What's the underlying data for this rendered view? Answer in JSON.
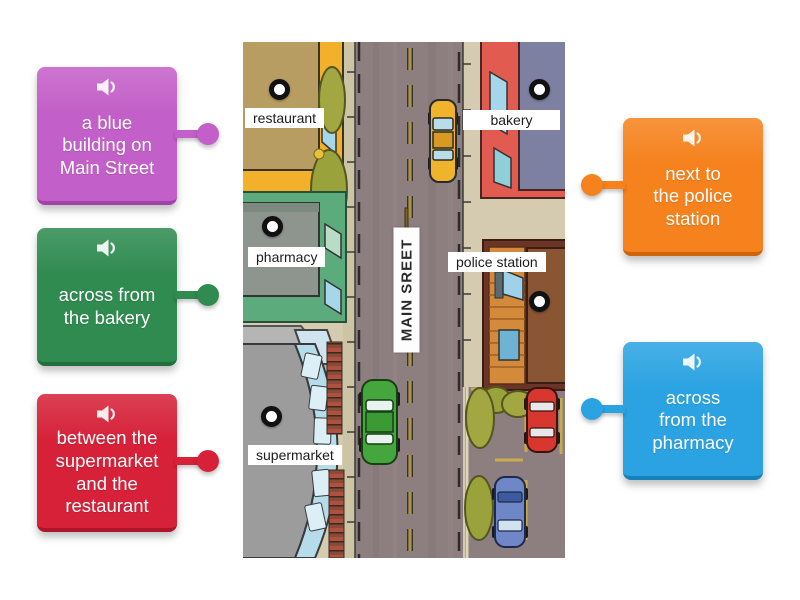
{
  "activity": {
    "type": "labelled-diagram",
    "cards": [
      {
        "id": "card-blue-building",
        "text": "a blue\nbuilding on\nMain Street",
        "color": "#c35fc8",
        "edge_color": "#a144a8",
        "side": "left",
        "audio_icon": "speaker"
      },
      {
        "id": "card-across-bakery",
        "text": "across from\nthe bakery",
        "color": "#2f8b50",
        "edge_color": "#226e3c",
        "side": "left",
        "audio_icon": "speaker"
      },
      {
        "id": "card-between",
        "text": "between the\nsupermarket\nand the\nrestaurant",
        "color": "#d62138",
        "edge_color": "#ae152a",
        "side": "left",
        "audio_icon": "speaker"
      },
      {
        "id": "card-next-police",
        "text": "next to\nthe police\nstation",
        "color": "#f5821d",
        "edge_color": "#cf650a",
        "side": "right",
        "audio_icon": "speaker"
      },
      {
        "id": "card-across-pharmacy",
        "text": "across\nfrom the\npharmacy",
        "color": "#2ba3e2",
        "edge_color": "#1781ba",
        "side": "right",
        "audio_icon": "speaker"
      }
    ]
  },
  "map": {
    "street_sign": "MAIN SREET",
    "labels": [
      "restaurant",
      "bakery",
      "pharmacy",
      "police station",
      "supermarket"
    ],
    "pin_count": 5
  }
}
